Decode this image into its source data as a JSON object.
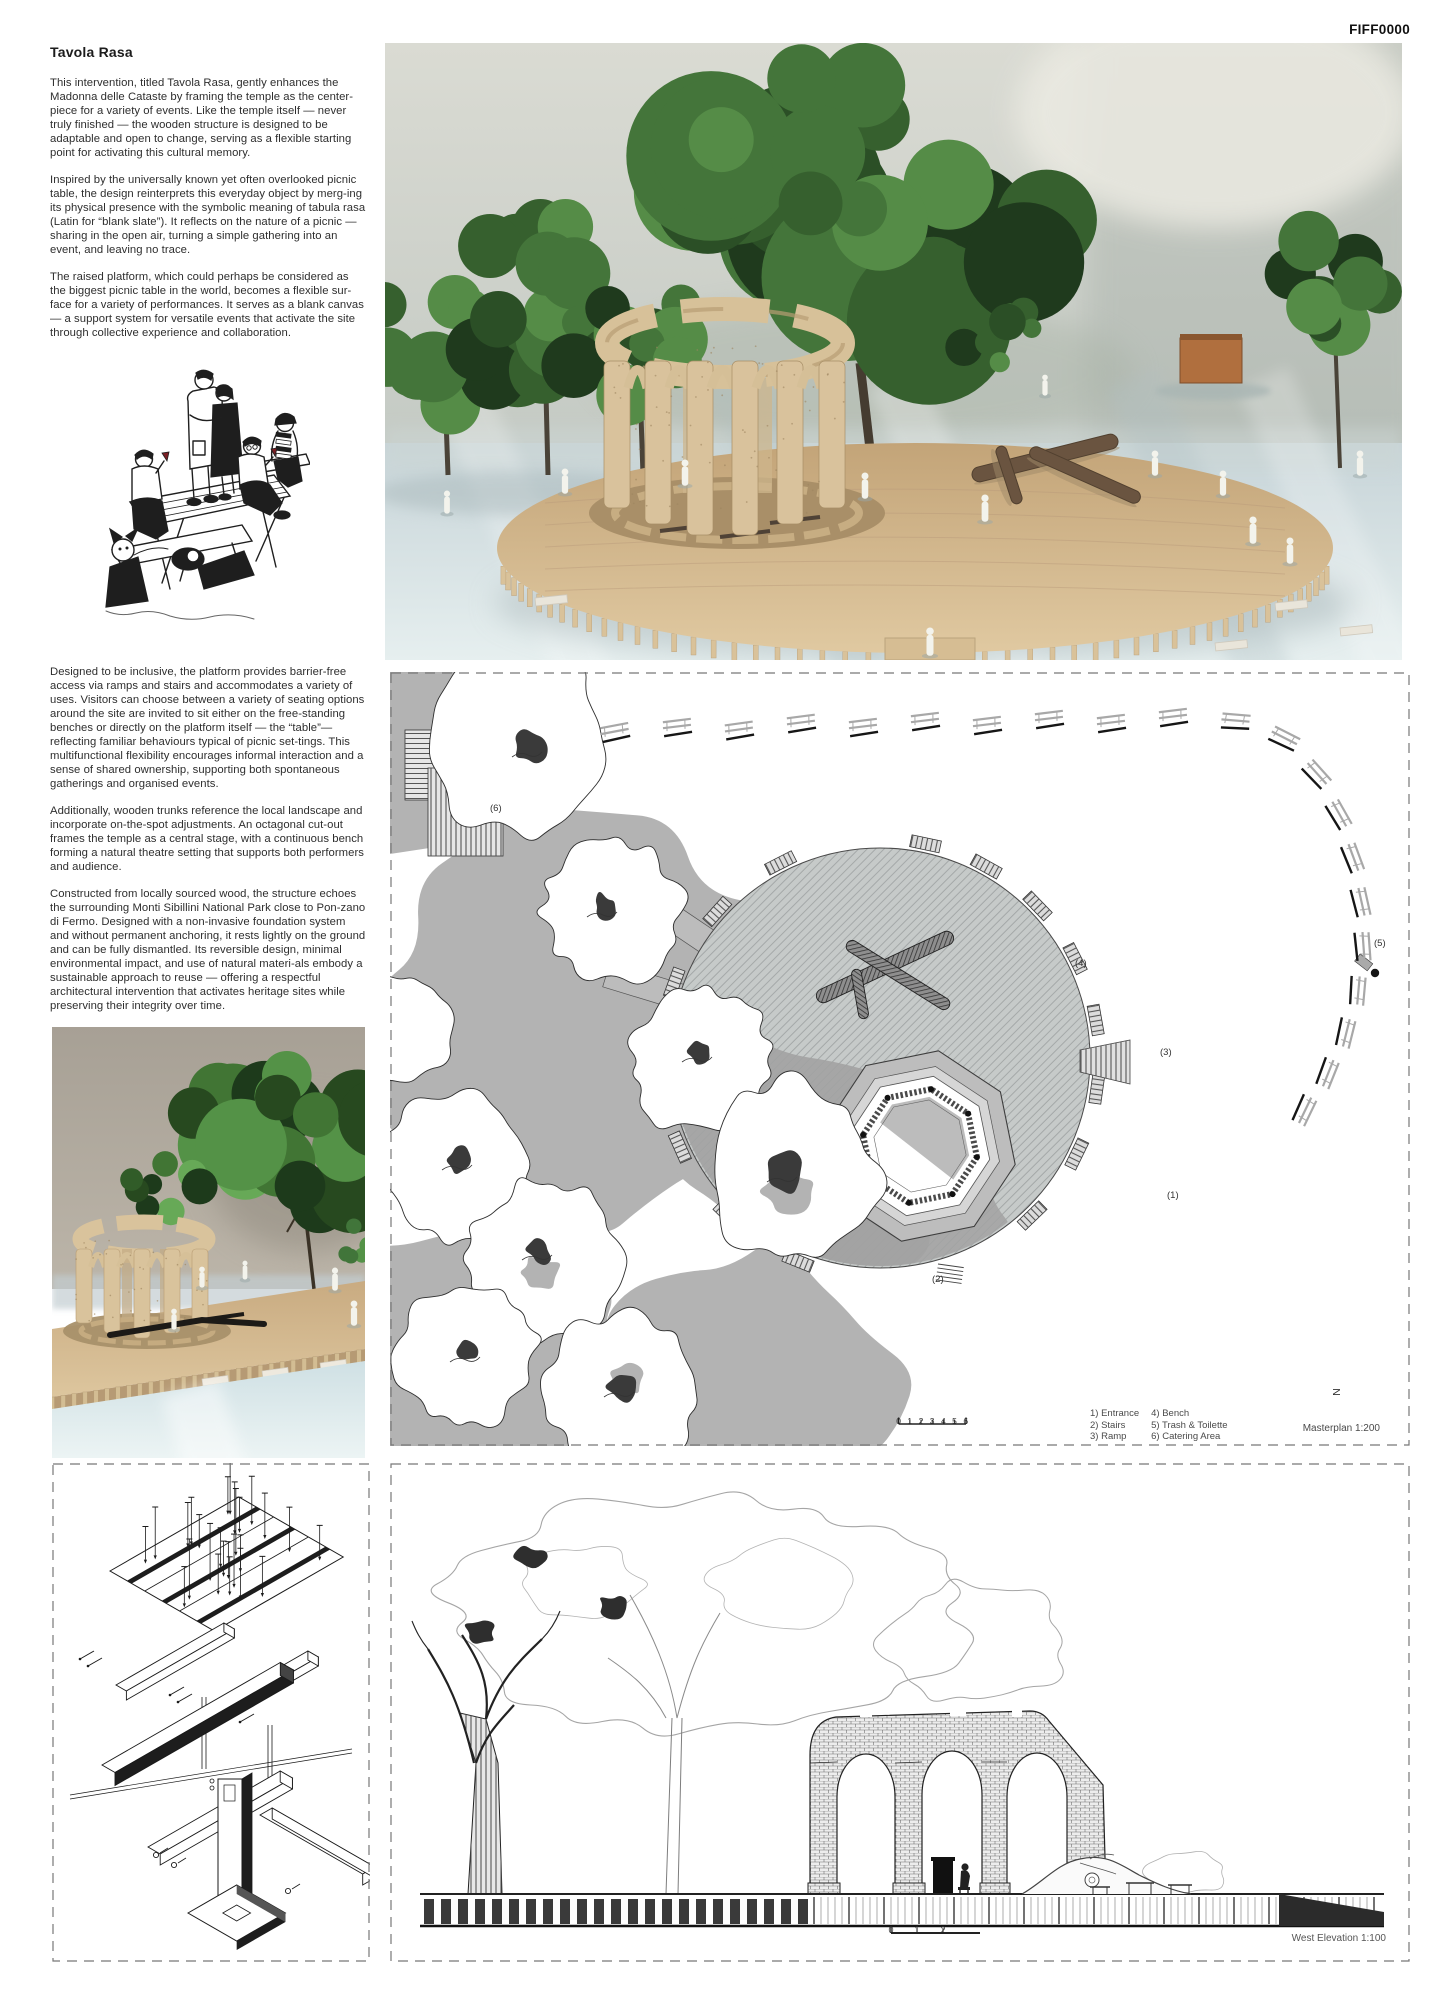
{
  "page": {
    "code": "FIFF0000"
  },
  "article": {
    "title": "Tavola Rasa",
    "paragraphs": [
      "This intervention, titled Tavola Rasa, gently enhances the Madonna delle Cataste by framing the temple as the center-piece for a variety of events. Like the temple itself — never truly finished — the wooden structure is designed to be adaptable and open to change, serving as a flexible starting point for activating this cultural memory.",
      "Inspired by the universally known yet often overlooked picnic table, the design reinterprets this everyday object by merg-ing its physical presence with the symbolic meaning of tabula rasa (Latin for “blank slate”). It reflects on the nature of a picnic — sharing in the open air, turning a simple gathering into an event, and leaving no trace.",
      "The raised platform, which could perhaps be considered as the biggest picnic table in the world, becomes a flexible sur-face for a variety of performances. It serves as a blank canvas — a support system for versatile events that activate the site through collective experience and collaboration.",
      "Designed to be inclusive, the platform provides barrier-free access via ramps and stairs and accommodates a variety of uses. Visitors can choose between a variety of seating options around the site are invited to sit either on the free-standing benches or directly on the platform itself — the “table”— reflecting familiar behaviours typical of picnic set-tings. This multifunctional flexibility encourages informal interaction and a sense of shared ownership, supporting both spontaneous gatherings and organised events.",
      "Additionally, wooden trunks reference the local landscape and incorporate on-the-spot adjustments. An octagonal cut-out frames the temple as a central stage, with a continuous bench forming a natural theatre setting that supports both performers and audience.",
      "Constructed from locally sourced wood, the structure echoes the surrounding Monti Sibillini National Park close to Pon-zano di Fermo. Designed with a non-invasive foundation system and without permanent anchoring, it rests lightly on the ground and can be fully dismantled. Its reversible design, minimal environmental impact, and use of natural materi-als embody a sustainable approach to reuse — offering a respectful architectural intervention that activates heritage sites while preserving their integrity over time."
    ]
  },
  "masterplan": {
    "plan_labels": {
      "l1": "(1)",
      "l2": "(2)",
      "l3": "(3)",
      "l4": "(4)",
      "l5": "(5)",
      "l6": "(6)"
    },
    "legend_col1": [
      "1) Entrance",
      "2) Stairs",
      "3) Ramp"
    ],
    "legend_col2": [
      "4) Bench",
      "5) Trash & Toilette",
      "6) Catering Area"
    ],
    "caption": "Masterplan 1:200",
    "north": "N",
    "scalebar": [
      "0",
      "1",
      "2",
      "3",
      "4",
      "5",
      "6"
    ]
  },
  "elevation": {
    "caption": "West Elevation 1:100",
    "scalebar": [
      "0",
      "1",
      "2"
    ]
  },
  "colors": {
    "wood": "#d3bb92",
    "foliage_dark": "#2b4f26",
    "plan_gray": "#b3b3b3",
    "line": "#222222",
    "wall": "#d6d7cf",
    "floor": "#dbe7e9"
  }
}
